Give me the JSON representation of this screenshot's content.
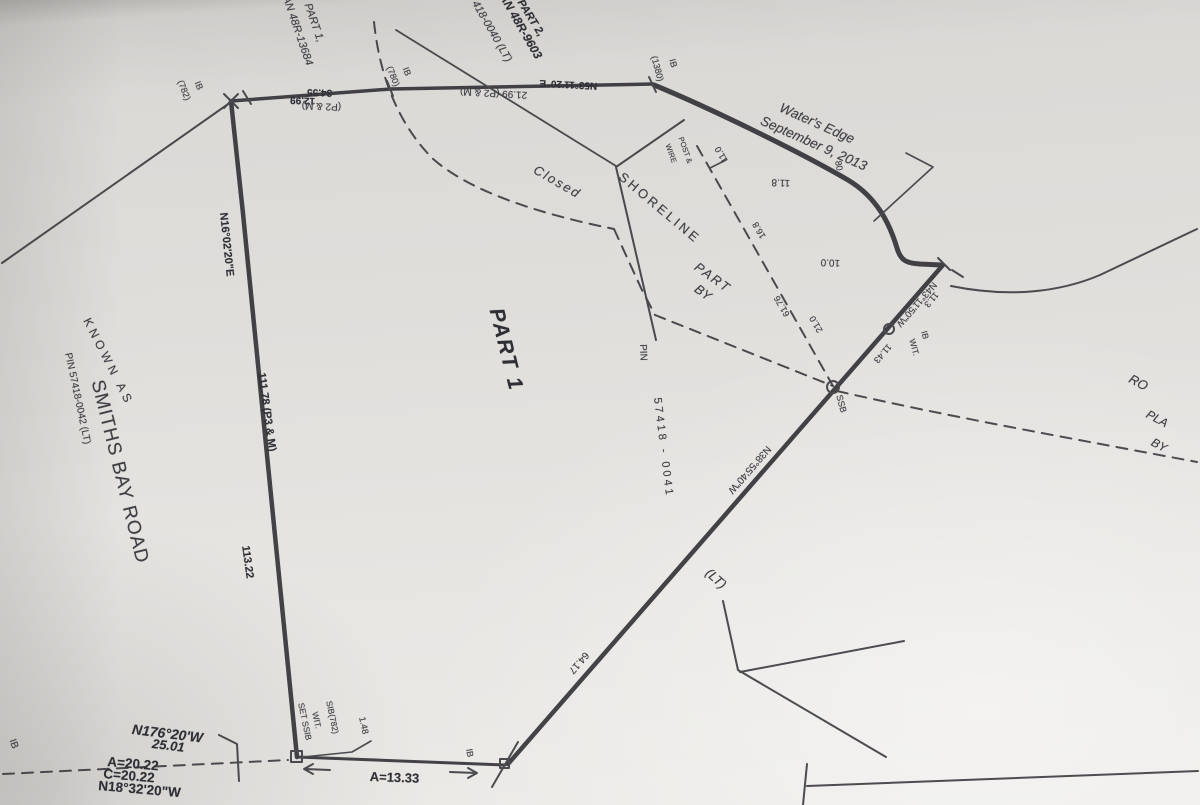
{
  "paper": {
    "line_color": "#35353b",
    "paper_tone": "#e0dedb"
  },
  "north_parcels": {
    "part1_l1": "PART 1,",
    "part1_l2": "PLAN 48R-13684",
    "pin_0040": "PIN 57418-0040 (LT)",
    "part2_l1": "PART 2,",
    "part2_l2": "PLAN 48R-9603"
  },
  "road": {
    "known_as": "KNOWN AS",
    "name": "SMITHS BAY ROAD",
    "pin": "PIN 57418-0042 (LT)"
  },
  "north_boundary": {
    "dist_a": "12.99",
    "dist_b": "34.55",
    "p2m": "(P2 & M)",
    "bearing": "N53°11'20\"E",
    "dist_c": "21.99 (P2 & M)",
    "mon_left": "IB",
    "mon_left_num": "(782)",
    "mon_mid": "IB",
    "mon_mid_num": "(780)",
    "mon_right": "IB",
    "mon_right_num": "(1380)"
  },
  "west_boundary": {
    "bearing": "N16°02'20\"E",
    "dist_a": "111.78 (P3 & M)",
    "dist_b": "113.22"
  },
  "part1": {
    "label": "PART 1"
  },
  "notes": {
    "closed": "Closed",
    "shoreline": "SHORELINE",
    "pin_arrow": "PIN",
    "fence_l1": "POST &",
    "fence_l2": "WIRE",
    "part_frag": "PART",
    "by_frag": "BY",
    "lt_frag": "(LT)",
    "ro_frag": "RO",
    "pla_frag": "PLA",
    "by_frag2": "BY"
  },
  "waters_edge": {
    "l1": "Water's Edge",
    "l2": "September 9, 2013",
    "pt_80": "80",
    "tie_118": "11.8",
    "tie_100": "10.0",
    "tie_110": "11.0",
    "tie_168": "16.8",
    "tie_6176": "61.76",
    "tie_210": "21.0"
  },
  "east_boundary": {
    "bearing_upper": "N43°11'50\"W",
    "tie_113": "11.3",
    "dist_1143": "11.43",
    "mon_ib": "IB",
    "mon_wit": "WIT.",
    "mon_ssb": "SSB",
    "pin_0041": "57418 - 0041",
    "bearing_lower": "N38°55'40\"W",
    "dist_6417": "64.17",
    "mon_ib_south": "IB"
  },
  "south_boundary": {
    "bearing_a": "N176°20'W",
    "dist_a": "25.01",
    "arc_a": "A=20.22",
    "chord_a": "C=20.22",
    "bearing_b": "N18°32'20\"W",
    "mon_edge_ib": "IB",
    "set_ssib": "SET SSIB",
    "wit": "WIT.",
    "sib_782": "SIB(782)",
    "tie_148": "1.48",
    "arc_b": "A=13.33"
  }
}
